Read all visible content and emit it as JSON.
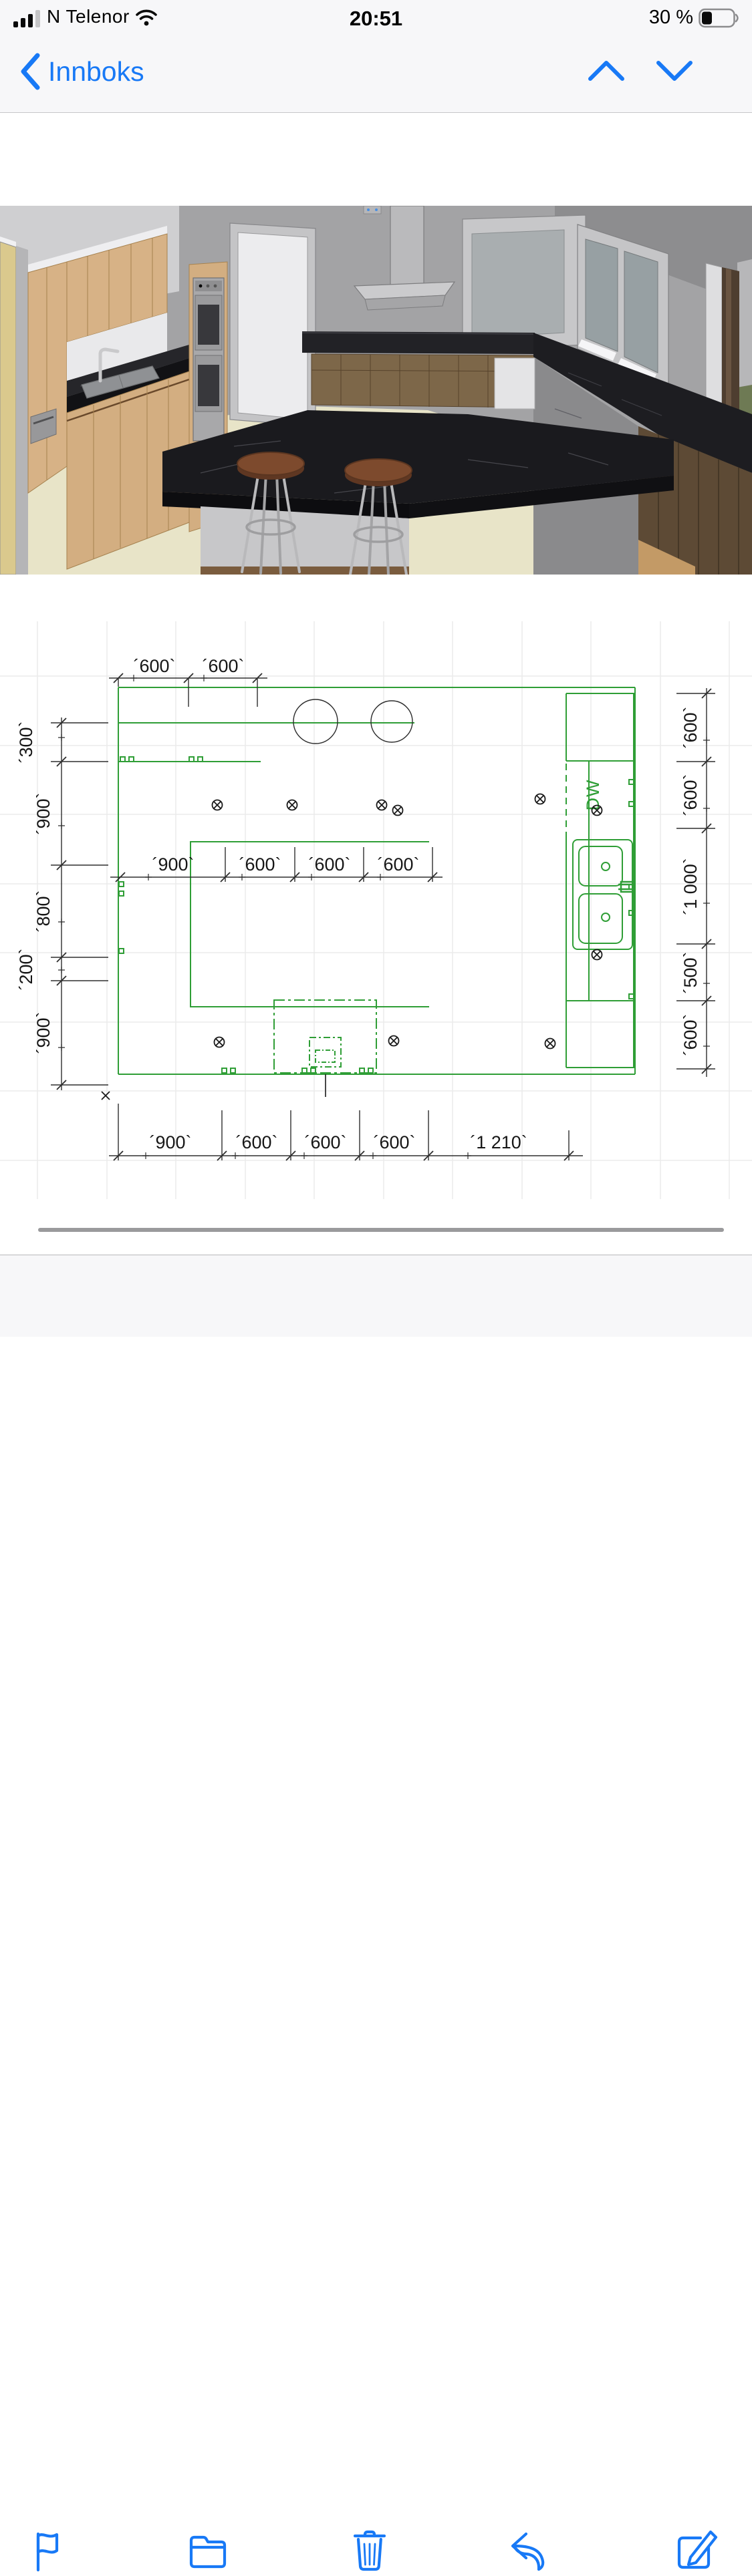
{
  "status": {
    "carrier": "N Telenor",
    "time": "20:51",
    "battery": "30 %"
  },
  "nav": {
    "back": "Innboks"
  },
  "toolbar": {
    "icons": [
      "flag",
      "folder",
      "trash",
      "reply",
      "compose"
    ]
  },
  "plan": {
    "dw": "DW",
    "dims": {
      "top": [
        "´600`",
        "´600`"
      ],
      "middle": [
        "´900`",
        "´600`",
        "´600`",
        "´600`"
      ],
      "bottom": [
        "´900`",
        "´600`",
        "´600`",
        "´600`",
        "´1 210`"
      ],
      "left": [
        "´300`",
        "´900`",
        "´800`",
        "´200`",
        "´900`"
      ],
      "right": [
        "´600`",
        "´600`",
        "´1 000`",
        "´500`",
        "´600`"
      ]
    }
  },
  "colors": {
    "accent": "#1879f6",
    "plan_green": "#2f9e36",
    "marble": "#1a1a1e",
    "wood_light": "#d7b286",
    "wood_dark": "#5d4a35"
  }
}
